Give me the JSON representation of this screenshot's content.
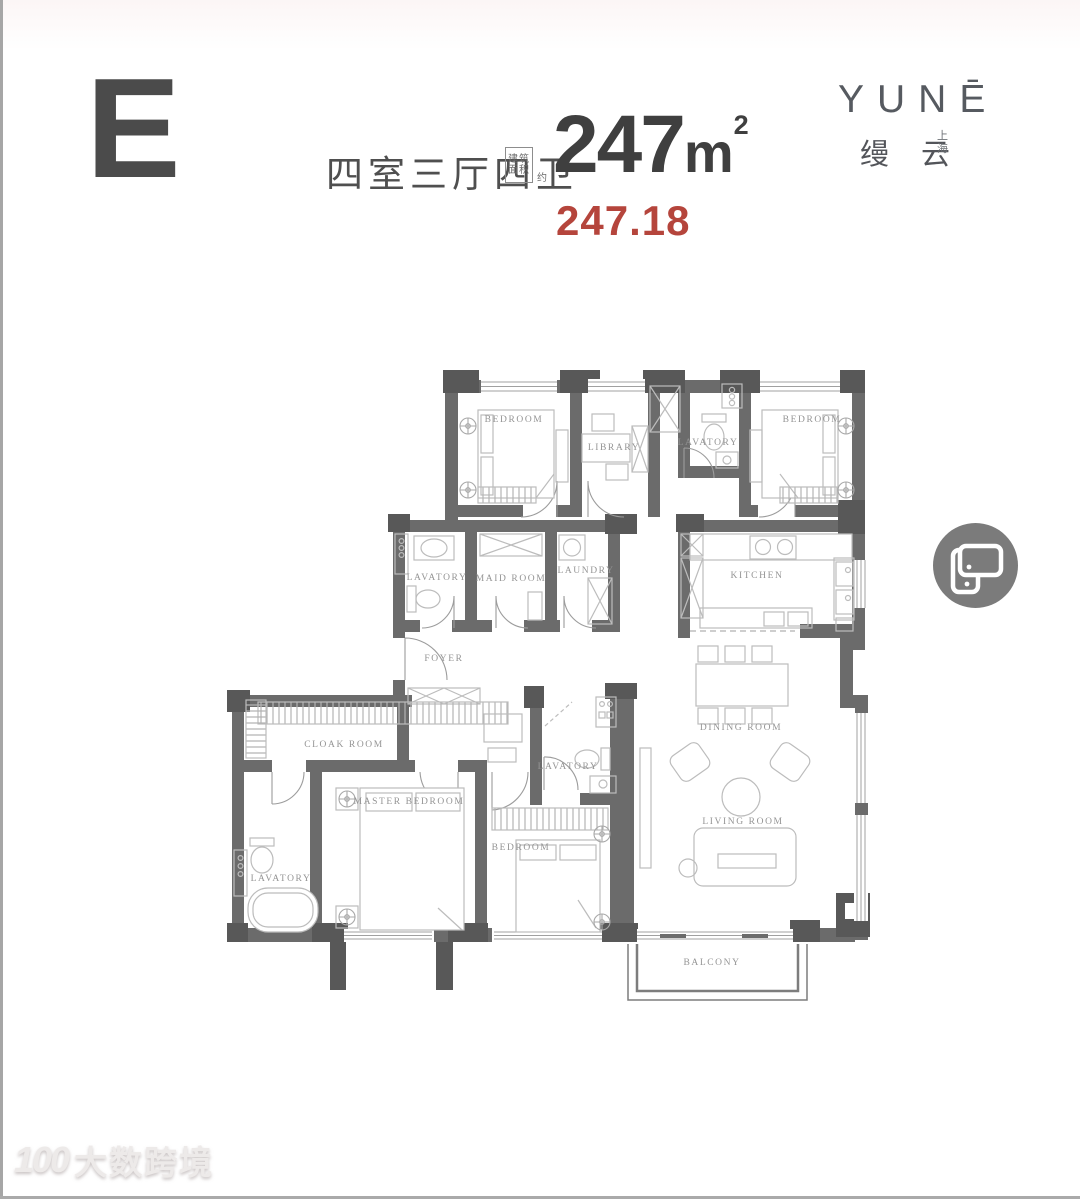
{
  "header": {
    "unit_letter": "E",
    "layout_label": "四室三厅四卫",
    "area_box_line1": "建筑",
    "area_box_line2": "面积",
    "area_approx": "约",
    "area_number": "247",
    "area_unit": "m",
    "area_superscript": "2",
    "area_exact": "247.18"
  },
  "brand": {
    "logo": "YUNĒ",
    "name_cn": "缦 云",
    "city_char1": "上",
    "city_char2": "海"
  },
  "side_icon": {
    "name": "rotate-device-icon"
  },
  "watermark": {
    "logo_number": "100",
    "text": "大数跨境"
  },
  "floorplan": {
    "rooms": [
      {
        "id": "bedroom-top-left",
        "label": "BEDROOM"
      },
      {
        "id": "library",
        "label": "LIBRARY"
      },
      {
        "id": "lavatory-top",
        "label": "LAVATORY"
      },
      {
        "id": "bedroom-top-right",
        "label": "BEDROOM"
      },
      {
        "id": "lavatory-mid",
        "label": "LAVATORY"
      },
      {
        "id": "maid-room",
        "label": "MAID ROOM"
      },
      {
        "id": "laundry",
        "label": "LAUNDRY"
      },
      {
        "id": "kitchen",
        "label": "KITCHEN"
      },
      {
        "id": "foyer",
        "label": "FOYER"
      },
      {
        "id": "cloak-room",
        "label": "CLOAK ROOM"
      },
      {
        "id": "master-bedroom",
        "label": "MASTER BEDROOM"
      },
      {
        "id": "lavatory-master",
        "label": "LAVATORY"
      },
      {
        "id": "lavatory-bedroom",
        "label": "LAVATORY"
      },
      {
        "id": "bedroom-bottom",
        "label": "BEDROOM"
      },
      {
        "id": "dining-room",
        "label": "DINING ROOM"
      },
      {
        "id": "living-room",
        "label": "LIVING ROOM"
      },
      {
        "id": "balcony",
        "label": "BALCONY"
      }
    ]
  },
  "colors": {
    "accent_red": "#b5453c",
    "wall_gray": "#6b6b6b",
    "column_gray": "#585858",
    "label_gray": "#949494",
    "icon_circle_gray": "#7b7b7b"
  }
}
